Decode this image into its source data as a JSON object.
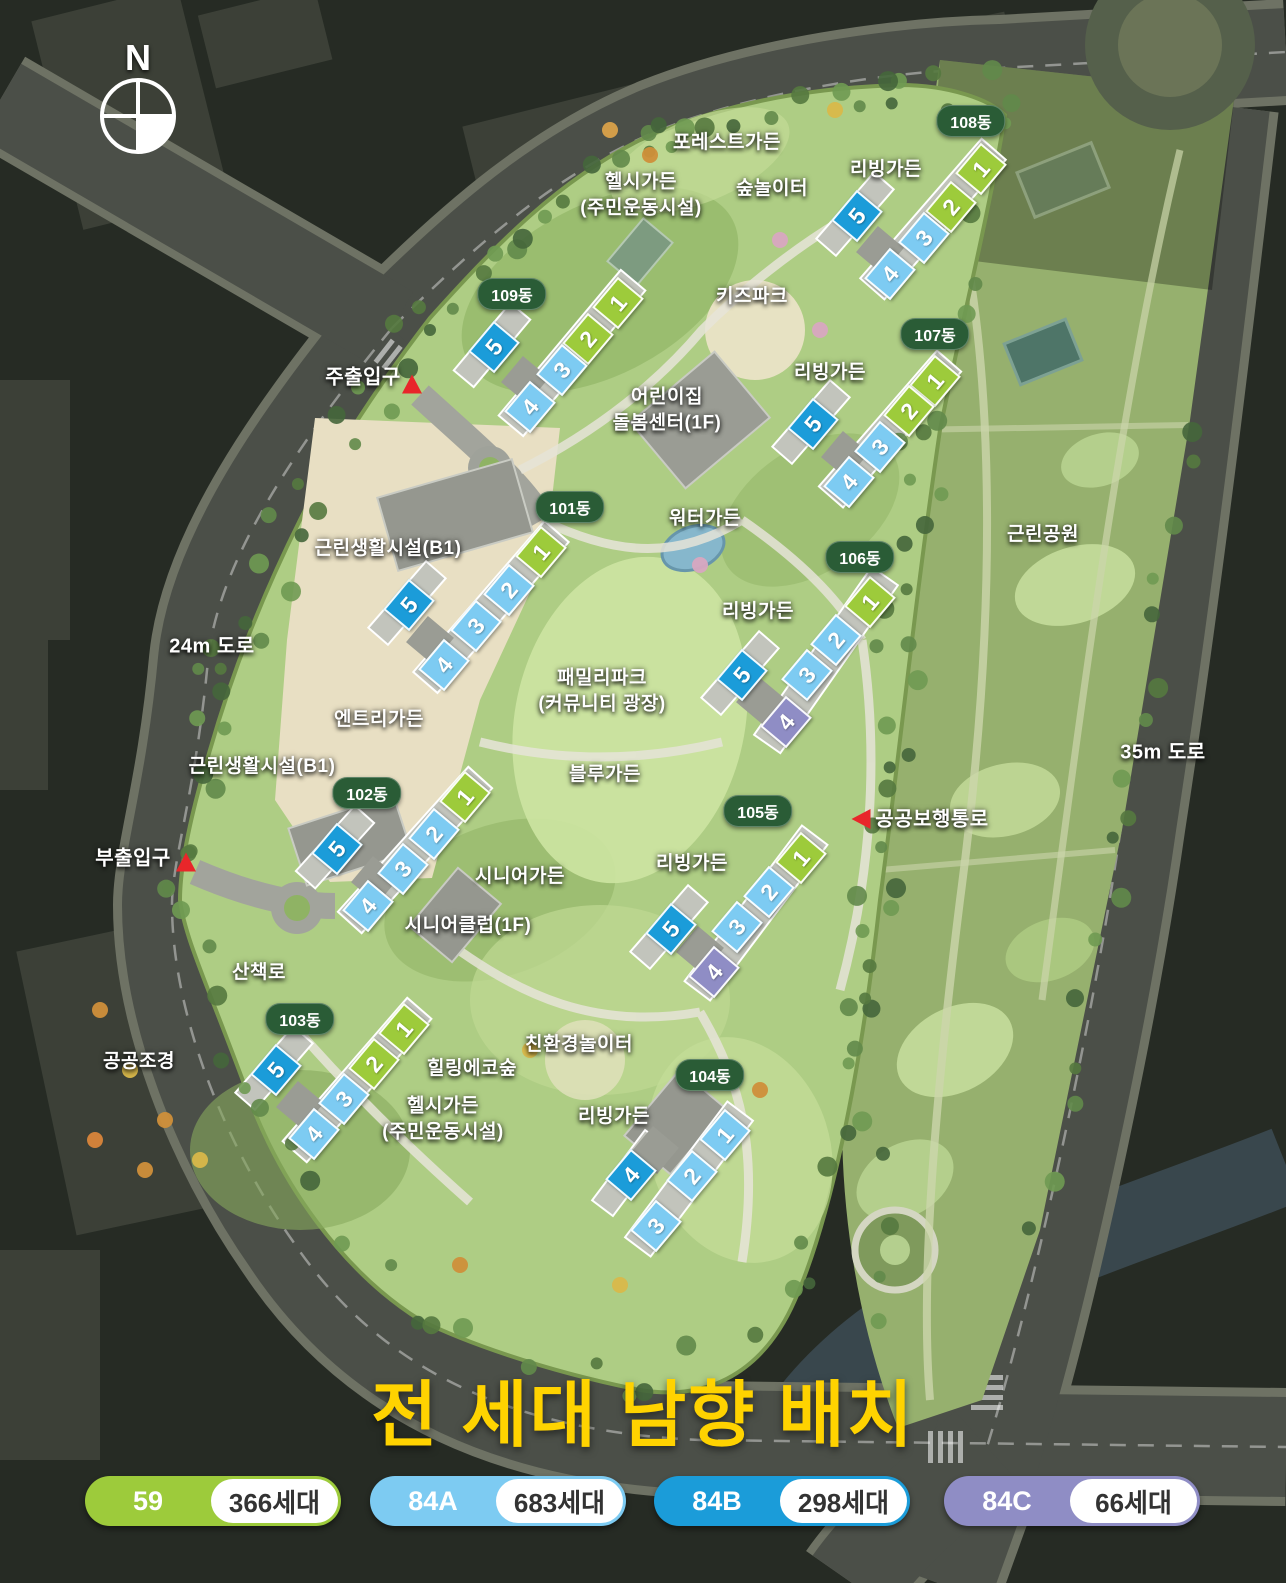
{
  "compass": {
    "letter": "N"
  },
  "title": {
    "text": "전 세대 남향 배치",
    "color": "#FFD300"
  },
  "badge_color": "#2A5C36",
  "unit_types": {
    "59": {
      "color": "#9DCB3B"
    },
    "84A": {
      "color": "#7DCBF2"
    },
    "84B": {
      "color": "#1B9CD9"
    },
    "84C": {
      "color": "#8F8DC5"
    }
  },
  "map_labels": [
    {
      "id": "forest-garden",
      "text": "포레스트가든",
      "x": 727,
      "y": 143
    },
    {
      "id": "healthy-garden-north",
      "text": "헬시가든\n(주민운동시설)",
      "x": 641,
      "y": 195
    },
    {
      "id": "forest-playground",
      "text": "숲놀이터",
      "x": 772,
      "y": 189
    },
    {
      "id": "living-garden-108",
      "text": "리빙가든",
      "x": 886,
      "y": 170
    },
    {
      "id": "kids-park",
      "text": "키즈파크",
      "x": 752,
      "y": 297
    },
    {
      "id": "daycare-center",
      "text": "어린이집\n돌봄센터(1F)",
      "x": 667,
      "y": 410
    },
    {
      "id": "living-garden-107",
      "text": "리빙가든",
      "x": 830,
      "y": 373
    },
    {
      "id": "water-garden",
      "text": "워터가든",
      "x": 705,
      "y": 519
    },
    {
      "id": "neighborhood-facility-north",
      "text": "근린생활시설(B1)",
      "x": 388,
      "y": 549
    },
    {
      "id": "neighborhood-park",
      "text": "근린공원",
      "x": 1043,
      "y": 535
    },
    {
      "id": "living-garden-106",
      "text": "리빙가든",
      "x": 758,
      "y": 612
    },
    {
      "id": "entry-garden",
      "text": "엔트리가든",
      "x": 379,
      "y": 720
    },
    {
      "id": "family-park",
      "text": "패밀리파크\n(커뮤니티 광장)",
      "x": 602,
      "y": 691
    },
    {
      "id": "neighborhood-facility-south",
      "text": "근린생활시설(B1)",
      "x": 262,
      "y": 767
    },
    {
      "id": "blue-garden",
      "text": "블루가든",
      "x": 605,
      "y": 775
    },
    {
      "id": "living-garden-105",
      "text": "리빙가든",
      "x": 692,
      "y": 864
    },
    {
      "id": "senior-garden",
      "text": "시니어가든",
      "x": 520,
      "y": 877
    },
    {
      "id": "senior-club",
      "text": "시니어클럽(1F)",
      "x": 468,
      "y": 926
    },
    {
      "id": "walking-trail",
      "text": "산책로",
      "x": 259,
      "y": 973
    },
    {
      "id": "public-landscape",
      "text": "공공조경",
      "x": 139,
      "y": 1062
    },
    {
      "id": "eco-playground",
      "text": "친환경놀이터",
      "x": 579,
      "y": 1045
    },
    {
      "id": "healing-eco-forest",
      "text": "힐링에코숲",
      "x": 472,
      "y": 1069
    },
    {
      "id": "healthy-garden-south",
      "text": "헬시가든\n(주민운동시설)",
      "x": 443,
      "y": 1119
    },
    {
      "id": "living-garden-104",
      "text": "리빙가든",
      "x": 614,
      "y": 1117
    }
  ],
  "road_labels": [
    {
      "id": "road-24m",
      "text": "24m 도로",
      "x": 212,
      "y": 647
    },
    {
      "id": "road-35m",
      "text": "35m 도로",
      "x": 1163,
      "y": 753
    }
  ],
  "entrances": [
    {
      "id": "main-entrance",
      "text": "주출입구",
      "x": 363,
      "y": 378,
      "tri_x": 412,
      "tri_y": 384,
      "dir": "up"
    },
    {
      "id": "sub-entrance",
      "text": "부출입구",
      "x": 133,
      "y": 859,
      "tri_x": 186,
      "tri_y": 862,
      "dir": "up"
    },
    {
      "id": "public-walkway",
      "text": "공공보행통로",
      "x": 932,
      "y": 820,
      "tri_x": 861,
      "tri_y": 819,
      "dir": "left"
    }
  ],
  "buildings": [
    {
      "name": "101동",
      "badge_x": 570,
      "badge_y": 507,
      "units": [
        {
          "no": "1",
          "type": "59",
          "x": 539,
          "y": 550
        },
        {
          "no": "2",
          "type": "84A",
          "x": 507,
          "y": 588
        },
        {
          "no": "3",
          "type": "84A",
          "x": 474,
          "y": 624
        },
        {
          "no": "4",
          "type": "84A",
          "x": 442,
          "y": 663
        },
        {
          "no": "5",
          "type": "84B",
          "x": 407,
          "y": 603
        }
      ]
    },
    {
      "name": "102동",
      "badge_x": 367,
      "badge_y": 793,
      "units": [
        {
          "no": "1",
          "type": "59",
          "x": 463,
          "y": 795
        },
        {
          "no": "2",
          "type": "84A",
          "x": 432,
          "y": 832
        },
        {
          "no": "3",
          "type": "84A",
          "x": 401,
          "y": 867
        },
        {
          "no": "4",
          "type": "84A",
          "x": 366,
          "y": 904
        },
        {
          "no": "5",
          "type": "84B",
          "x": 335,
          "y": 847
        }
      ]
    },
    {
      "name": "103동",
      "badge_x": 300,
      "badge_y": 1019,
      "units": [
        {
          "no": "1",
          "type": "59",
          "x": 402,
          "y": 1027
        },
        {
          "no": "2",
          "type": "59",
          "x": 372,
          "y": 1062
        },
        {
          "no": "3",
          "type": "84A",
          "x": 342,
          "y": 1097
        },
        {
          "no": "4",
          "type": "84A",
          "x": 312,
          "y": 1132
        },
        {
          "no": "5",
          "type": "84B",
          "x": 274,
          "y": 1068
        }
      ]
    },
    {
      "name": "104동",
      "badge_x": 710,
      "badge_y": 1075,
      "units": [
        {
          "no": "1",
          "type": "84A",
          "x": 723,
          "y": 1133
        },
        {
          "no": "2",
          "type": "84A",
          "x": 690,
          "y": 1174
        },
        {
          "no": "3",
          "type": "84A",
          "x": 654,
          "y": 1224
        },
        {
          "no": "4",
          "type": "84B",
          "x": 629,
          "y": 1173
        }
      ]
    },
    {
      "name": "105동",
      "badge_x": 758,
      "badge_y": 811,
      "units": [
        {
          "no": "1",
          "type": "59",
          "x": 799,
          "y": 856
        },
        {
          "no": "2",
          "type": "84A",
          "x": 767,
          "y": 890
        },
        {
          "no": "3",
          "type": "84A",
          "x": 735,
          "y": 925
        },
        {
          "no": "4",
          "type": "84C",
          "x": 712,
          "y": 970
        },
        {
          "no": "5",
          "type": "84B",
          "x": 669,
          "y": 927
        }
      ]
    },
    {
      "name": "106동",
      "badge_x": 860,
      "badge_y": 557,
      "units": [
        {
          "no": "1",
          "type": "59",
          "x": 868,
          "y": 600
        },
        {
          "no": "2",
          "type": "84A",
          "x": 834,
          "y": 638
        },
        {
          "no": "3",
          "type": "84A",
          "x": 805,
          "y": 673
        },
        {
          "no": "4",
          "type": "84C",
          "x": 784,
          "y": 720
        },
        {
          "no": "5",
          "type": "84B",
          "x": 740,
          "y": 673
        }
      ]
    },
    {
      "name": "107동",
      "badge_x": 935,
      "badge_y": 334,
      "units": [
        {
          "no": "1",
          "type": "59",
          "x": 933,
          "y": 379
        },
        {
          "no": "2",
          "type": "59",
          "x": 907,
          "y": 409
        },
        {
          "no": "3",
          "type": "84A",
          "x": 878,
          "y": 445
        },
        {
          "no": "4",
          "type": "84A",
          "x": 847,
          "y": 480
        },
        {
          "no": "5",
          "type": "84B",
          "x": 811,
          "y": 422
        }
      ]
    },
    {
      "name": "108동",
      "badge_x": 971,
      "badge_y": 121,
      "units": [
        {
          "no": "1",
          "type": "59",
          "x": 979,
          "y": 167
        },
        {
          "no": "2",
          "type": "59",
          "x": 949,
          "y": 205
        },
        {
          "no": "3",
          "type": "84A",
          "x": 922,
          "y": 236
        },
        {
          "no": "4",
          "type": "84A",
          "x": 888,
          "y": 272
        },
        {
          "no": "5",
          "type": "84B",
          "x": 855,
          "y": 214
        }
      ]
    },
    {
      "name": "109동",
      "badge_x": 512,
      "badge_y": 294,
      "units": [
        {
          "no": "1",
          "type": "59",
          "x": 616,
          "y": 301
        },
        {
          "no": "2",
          "type": "59",
          "x": 586,
          "y": 337
        },
        {
          "no": "3",
          "type": "84A",
          "x": 560,
          "y": 368
        },
        {
          "no": "4",
          "type": "84A",
          "x": 528,
          "y": 405
        },
        {
          "no": "5",
          "type": "84B",
          "x": 492,
          "y": 345
        }
      ]
    }
  ],
  "legend": {
    "items": [
      {
        "type": "59",
        "count": "366세대"
      },
      {
        "type": "84A",
        "count": "683세대"
      },
      {
        "type": "84B",
        "count": "298세대"
      },
      {
        "type": "84C",
        "count": "66세대"
      }
    ]
  }
}
